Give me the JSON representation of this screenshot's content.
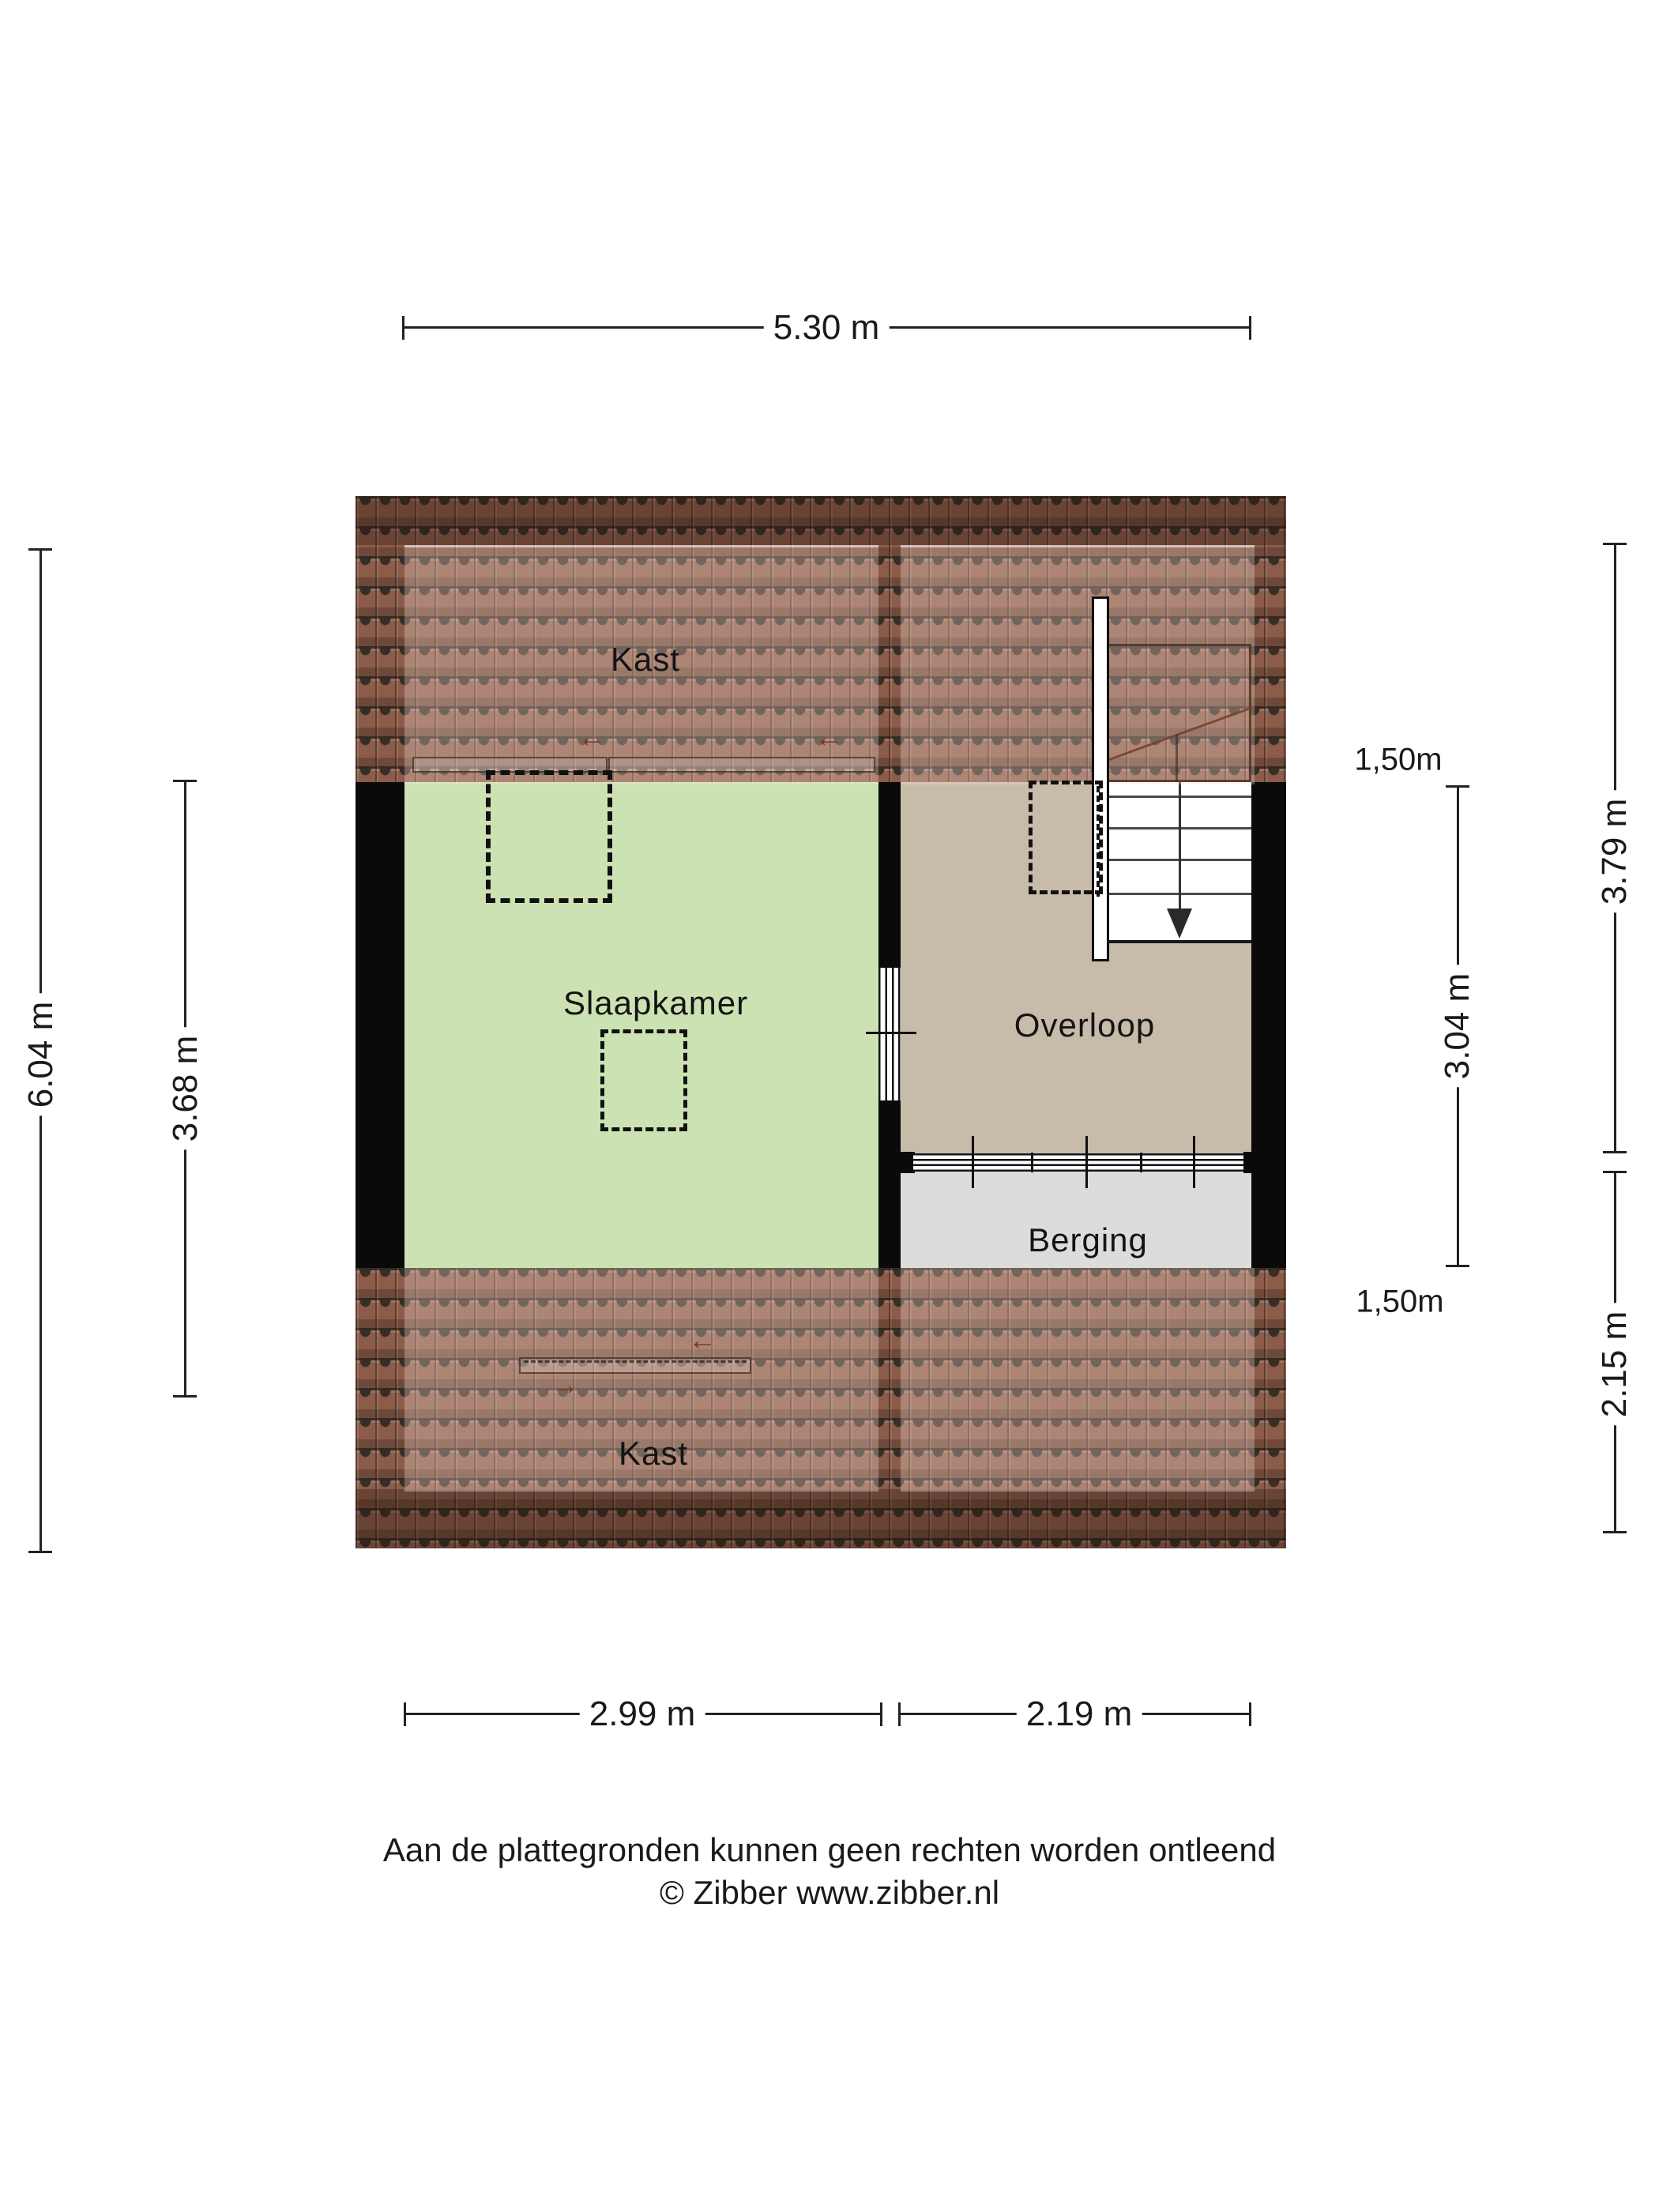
{
  "plan": {
    "rooms": {
      "kast_top": {
        "label": "Kast"
      },
      "slaapkamer": {
        "label": "Slaapkamer"
      },
      "overloop": {
        "label": "Overloop"
      },
      "berging": {
        "label": "Berging"
      },
      "kast_bottom": {
        "label": "Kast"
      }
    },
    "glyphs": {
      "arrow_left": "←",
      "arrow_right": "→"
    }
  },
  "dimensions": {
    "top_width": "5.30 m",
    "left_total_height": "6.04 m",
    "left_room_depth": "3.68 m",
    "right_room_depth": "3.04 m",
    "right_upper_height": "3.79 m",
    "right_lower_height": "2.15 m",
    "bottom_left_width": "2.99 m",
    "bottom_right_width": "2.19 m",
    "height_marker_top": "1,50m",
    "height_marker_bottom": "1,50m"
  },
  "footer": {
    "disclaimer": "Aan de plattegronden kunnen geen rechten worden ontleend",
    "copyright": "© Zibber www.zibber.nl"
  },
  "colors": {
    "background": "#ffffff",
    "wall": "#0a0a0a",
    "slaapkamer_fill": "#cde2b3",
    "overloop_fill": "#c7bbaa",
    "berging_fill": "#dcdcda",
    "roof_tile_base": "#8a5c49",
    "roof_shadow_line": "#3d342c",
    "dimension_line": "#222222",
    "label_text": "#1a1a1a"
  }
}
